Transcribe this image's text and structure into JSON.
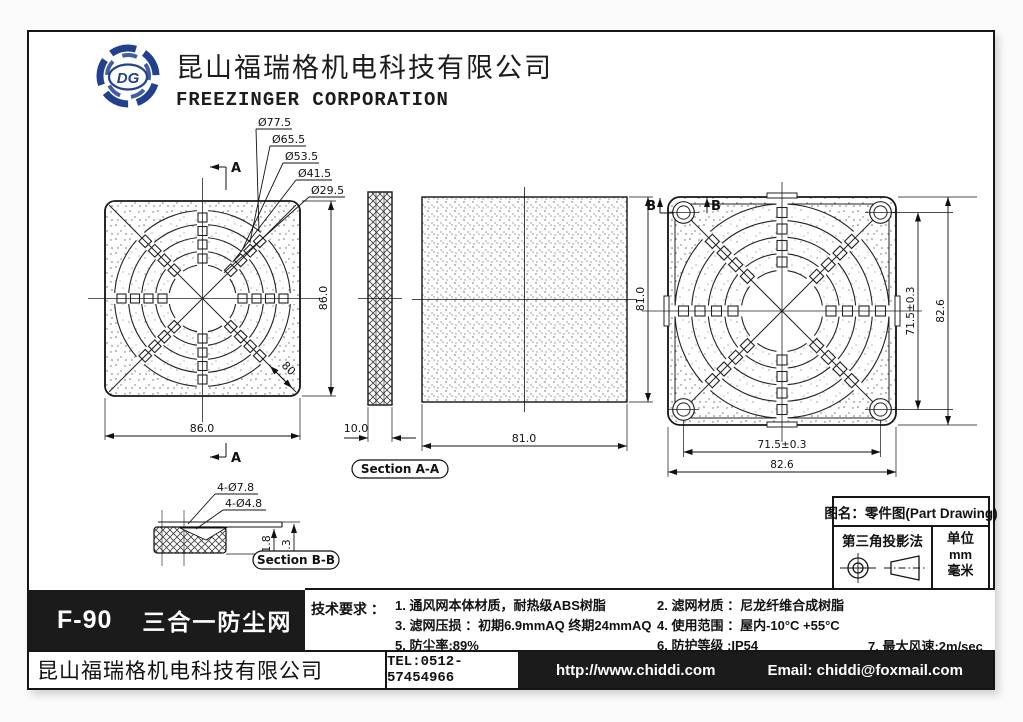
{
  "header": {
    "company_cn": "昆山福瑞格机电科技有限公司",
    "company_en": "FREEZINGER CORPORATION",
    "logo_text": "DG"
  },
  "drawing": {
    "callouts": {
      "c1": "Ø77.5",
      "c2": "Ø65.5",
      "c3": "Ø53.5",
      "c4": "Ø41.5",
      "c5": "Ø29.5"
    },
    "left_view": {
      "width": "86.0",
      "height": "86.0",
      "diag": "80",
      "marker_top": "A",
      "marker_bottom": "A"
    },
    "section_a": {
      "thickness": "10.0",
      "label": "Section A-A"
    },
    "filter": {
      "width": "81.0",
      "height": "81.0"
    },
    "right_view": {
      "marker_left": "B",
      "marker_right": "B",
      "hole_span_v": "71.5±0.3",
      "height": "82.6",
      "hole_span_h": "71.5±0.3",
      "width": "82.6"
    },
    "detail": {
      "callout_outer": "4-Ø7.8",
      "callout_inner": "4-Ø4.8",
      "dim_small": "1.8",
      "dim_large": "4.3",
      "label": "Section B-B"
    }
  },
  "title_block": {
    "drawing_name": "图名：零件图(Part Drawing)",
    "projection": "第三角投影法",
    "unit_label": "单位",
    "unit_mm": "mm",
    "unit_cn": "毫米"
  },
  "product": {
    "model": "F-90",
    "name": "三合一防尘网"
  },
  "tech": {
    "label": "技术要求 ：",
    "item1": "1. 通风网本体材质，耐热级ABS树脂",
    "item2": "2. 滤网材质 ：尼龙纤维合成树脂",
    "item3": "3. 滤网压损 ：初期6.9mmAQ  终期24mmAQ",
    "item4": "4. 使用范围 ：屋内-10°C +55°C",
    "item5": "5. 防尘率:89%",
    "item6": "6. 防护等级 :IP54",
    "item7": "7. 最大风速:2m/sec"
  },
  "footer": {
    "company": "昆山福瑞格机电科技有限公司",
    "tel": "TEL:0512-57454966",
    "website": "http://www.chiddi.com",
    "email": "Email: chiddi@foxmail.com"
  }
}
